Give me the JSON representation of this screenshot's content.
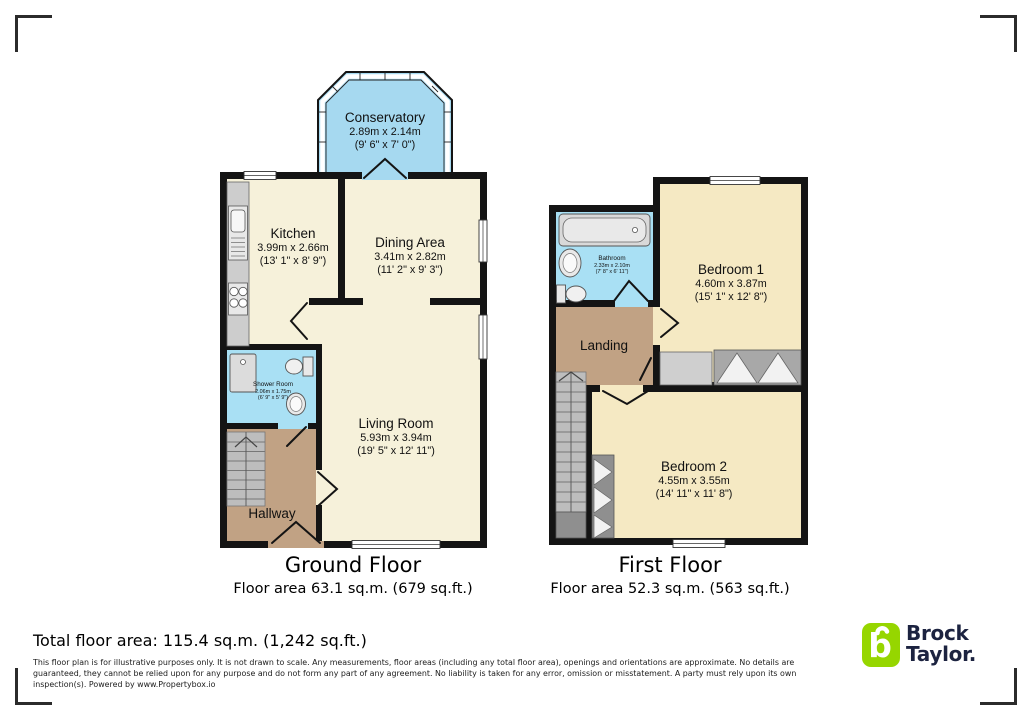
{
  "ground_floor": {
    "title": "Ground Floor",
    "area": "Floor area 63.1 sq.m. (679 sq.ft.)",
    "rooms": {
      "conservatory": {
        "name": "Conservatory",
        "metric": "2.89m x 2.14m",
        "imperial": "(9' 6\" x 7' 0\")"
      },
      "kitchen": {
        "name": "Kitchen",
        "metric": "3.99m x 2.66m",
        "imperial": "(13' 1\" x 8' 9\")"
      },
      "dining": {
        "name": "Dining Area",
        "metric": "3.41m x 2.82m",
        "imperial": "(11' 2\" x 9' 3\")"
      },
      "living": {
        "name": "Living Room",
        "metric": "5.93m x 3.94m",
        "imperial": "(19' 5\" x 12' 11\")"
      },
      "shower": {
        "name": "Shower Room",
        "metric": "2.06m x 1.75m",
        "imperial": "(6' 9\" x 5' 9\")"
      },
      "hallway": {
        "name": "Hallway"
      }
    }
  },
  "first_floor": {
    "title": "First Floor",
    "area": "Floor area 52.3 sq.m. (563 sq.ft.)",
    "rooms": {
      "bathroom": {
        "name": "Bathroom",
        "metric": "2.33m x 2.10m",
        "imperial": "(7' 8\" x 6' 11\")"
      },
      "bedroom1": {
        "name": "Bedroom 1",
        "metric": "4.60m x 3.87m",
        "imperial": "(15' 1\" x 12' 8\")"
      },
      "landing": {
        "name": "Landing"
      },
      "bedroom2": {
        "name": "Bedroom 2",
        "metric": "4.55m x 3.55m",
        "imperial": "(14' 11\" x 11' 8\")"
      }
    }
  },
  "footer": {
    "total_area": "Total floor area: 115.4 sq.m. (1,242 sq.ft.)",
    "disclaimer": "This floor plan is for illustrative purposes only. It is not drawn to scale. Any measurements, floor areas (including any total floor area), openings and orientations are approximate. No details are guaranteed, they cannot be relied upon for any purpose and do not form any part of any agreement. No liability is taken for any error, omission or misstatement. A party must rely upon its own inspection(s). Powered by www.Propertybox.io"
  },
  "brand": {
    "line1": "Brock",
    "line2": "Taylor.",
    "logo_letter": "b",
    "green": "#96d600",
    "navy": "#1c2340"
  },
  "colors": {
    "wall": "#141414",
    "ground_room_cream": "#f6f1da",
    "bedroom_cream": "#f5e9c3",
    "wet_room_blue": "#a9e0f4",
    "conservatory_blue": "#a6d9f0",
    "hall_tan": "#c1a284"
  }
}
